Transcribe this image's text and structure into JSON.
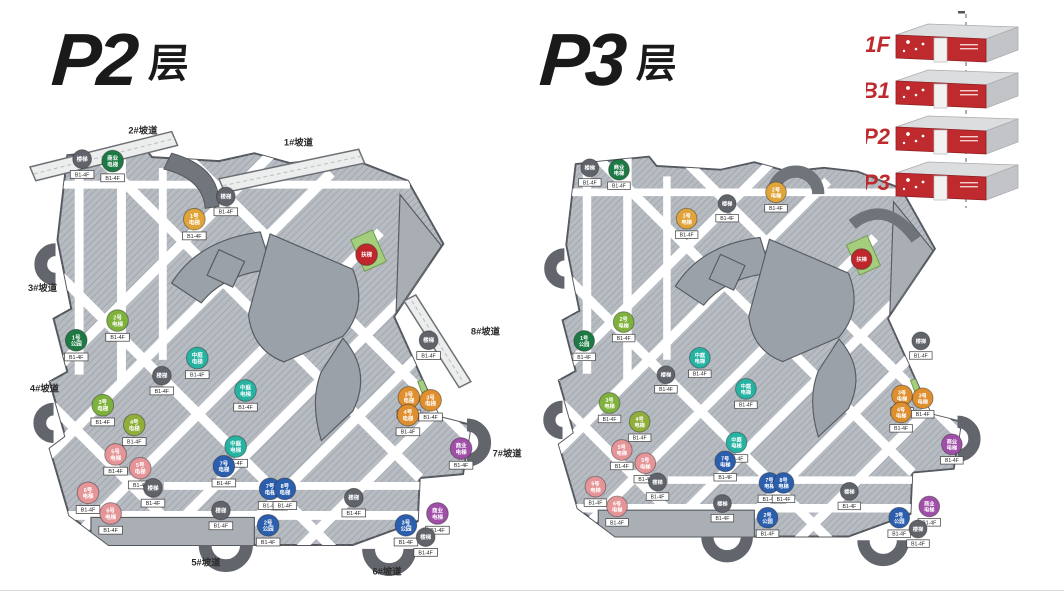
{
  "page": {
    "background": "#ffffff"
  },
  "titles": [
    {
      "main": "P2",
      "suffix": "层"
    },
    {
      "main": "P3",
      "suffix": "层"
    }
  ],
  "legend": {
    "accent": "#bf2a2e",
    "box_top": "#dcdddf",
    "box_side": "#c2c4c7",
    "levels": [
      "1F",
      "B1",
      "P2",
      "P3"
    ]
  },
  "palette": {
    "gray": "#60646a",
    "green": "#1e7a44",
    "lime": "#7fb23c",
    "olive": "#8fae3a",
    "teal": "#27b3a2",
    "orange": "#df8f2e",
    "amber": "#e0a43a",
    "blue": "#2b5fae",
    "pink": "#e59598",
    "purple": "#a04fa8",
    "red": "#c0272d"
  },
  "map_colors": {
    "body": "#b7bbc2",
    "lane": "#ffffff",
    "core": "#9ba1a9",
    "ramp": "#eceded",
    "loop": "#62666c",
    "green_patch": "#a5cd7e"
  },
  "marker_tag_default": "B1-4F",
  "plans": [
    {
      "name": "P2层",
      "variant": "a",
      "ramps": [
        {
          "label": "2#坡道",
          "x": 104,
          "y": 10
        },
        {
          "label": "1#坡道",
          "x": 262,
          "y": 22
        },
        {
          "label": "3#坡道",
          "x": 2,
          "y": 170
        },
        {
          "label": "4#坡道",
          "x": 4,
          "y": 272
        },
        {
          "label": "5#坡道",
          "x": 168,
          "y": 449
        },
        {
          "label": "6#坡道",
          "x": 352,
          "y": 458
        },
        {
          "label": "7#坡道",
          "x": 474,
          "y": 338
        },
        {
          "label": "8#坡道",
          "x": 452,
          "y": 214
        }
      ],
      "markers": [
        {
          "x": 57,
          "y": 36,
          "c": "gray",
          "t": [
            "楼梯"
          ]
        },
        {
          "x": 88,
          "y": 38,
          "c": "green",
          "t": [
            "商业",
            "电梯"
          ]
        },
        {
          "x": 171,
          "y": 97,
          "c": "amber",
          "t": [
            "1号",
            "电梯"
          ]
        },
        {
          "x": 203,
          "y": 74,
          "c": "gray",
          "t": [
            "楼梯"
          ]
        },
        {
          "x": 346,
          "y": 133,
          "c": "red",
          "t": [
            "扶梯"
          ],
          "tag": ""
        },
        {
          "x": 93,
          "y": 200,
          "c": "lime",
          "t": [
            "2号",
            "电梯"
          ]
        },
        {
          "x": 51,
          "y": 220,
          "c": "green",
          "t": [
            "1号",
            "公园"
          ]
        },
        {
          "x": 78,
          "y": 286,
          "c": "lime",
          "t": [
            "3号",
            "电梯"
          ]
        },
        {
          "x": 110,
          "y": 306,
          "c": "olive",
          "t": [
            "4号",
            "电梯"
          ]
        },
        {
          "x": 138,
          "y": 256,
          "c": "gray",
          "t": [
            "楼梯"
          ]
        },
        {
          "x": 174,
          "y": 238,
          "c": "teal",
          "t": [
            "中庭",
            "电梯"
          ]
        },
        {
          "x": 223,
          "y": 271,
          "c": "teal",
          "t": [
            "中庭",
            "电梯"
          ]
        },
        {
          "x": 409,
          "y": 220,
          "c": "gray",
          "t": [
            "楼梯"
          ]
        },
        {
          "x": 91,
          "y": 336,
          "c": "pink",
          "t": [
            "5号",
            "电梯"
          ]
        },
        {
          "x": 116,
          "y": 350,
          "c": "pink",
          "t": [
            "5号",
            "电梯"
          ]
        },
        {
          "x": 63,
          "y": 375,
          "c": "pink",
          "t": [
            "6号",
            "电梯"
          ]
        },
        {
          "x": 86,
          "y": 396,
          "c": "pink",
          "t": [
            "6号",
            "电梯"
          ]
        },
        {
          "x": 129,
          "y": 370,
          "c": "gray",
          "t": [
            "楼梯"
          ]
        },
        {
          "x": 213,
          "y": 328,
          "c": "teal",
          "t": [
            "中庭",
            "电梯"
          ]
        },
        {
          "x": 201,
          "y": 348,
          "c": "blue",
          "t": [
            "7号",
            "电梯"
          ]
        },
        {
          "x": 248,
          "y": 371,
          "c": "blue",
          "t": [
            "7号",
            "电梯"
          ]
        },
        {
          "x": 263,
          "y": 371,
          "c": "blue",
          "t": [
            "8号",
            "电梯"
          ]
        },
        {
          "x": 246,
          "y": 408,
          "c": "blue",
          "t": [
            "2号",
            "公园"
          ]
        },
        {
          "x": 198,
          "y": 393,
          "c": "gray",
          "t": [
            "楼梯"
          ]
        },
        {
          "x": 389,
          "y": 278,
          "c": "orange",
          "t": [
            "3号",
            "电梯"
          ]
        },
        {
          "x": 411,
          "y": 281,
          "c": "orange",
          "t": [
            "3号",
            "电梯"
          ]
        },
        {
          "x": 388,
          "y": 296,
          "c": "orange",
          "t": [
            "4号",
            "电梯"
          ]
        },
        {
          "x": 442,
          "y": 330,
          "c": "purple",
          "t": [
            "商业",
            "电梯"
          ]
        },
        {
          "x": 418,
          "y": 396,
          "c": "purple",
          "t": [
            "商业",
            "电梯"
          ]
        },
        {
          "x": 386,
          "y": 408,
          "c": "blue",
          "t": [
            "3号",
            "公园"
          ]
        },
        {
          "x": 406,
          "y": 420,
          "c": "gray",
          "t": [
            "楼梯"
          ]
        },
        {
          "x": 333,
          "y": 380,
          "c": "gray",
          "t": [
            "楼梯"
          ]
        }
      ]
    },
    {
      "name": "P3层",
      "variant": "b",
      "ramps": [],
      "markers": [
        {
          "x": 57,
          "y": 36,
          "c": "gray",
          "t": [
            "楼梯"
          ]
        },
        {
          "x": 88,
          "y": 38,
          "c": "green",
          "t": [
            "商业",
            "电梯"
          ]
        },
        {
          "x": 160,
          "y": 90,
          "c": "amber",
          "t": [
            "1号",
            "电梯"
          ]
        },
        {
          "x": 255,
          "y": 62,
          "c": "amber",
          "t": [
            "2号",
            "电梯"
          ]
        },
        {
          "x": 203,
          "y": 74,
          "c": "gray",
          "t": [
            "楼梯"
          ]
        },
        {
          "x": 346,
          "y": 133,
          "c": "red",
          "t": [
            "扶梯"
          ],
          "tag": ""
        },
        {
          "x": 93,
          "y": 200,
          "c": "lime",
          "t": [
            "2号",
            "电梯"
          ]
        },
        {
          "x": 51,
          "y": 220,
          "c": "green",
          "t": [
            "1号",
            "公园"
          ]
        },
        {
          "x": 78,
          "y": 286,
          "c": "lime",
          "t": [
            "3号",
            "电梯"
          ]
        },
        {
          "x": 110,
          "y": 306,
          "c": "olive",
          "t": [
            "4号",
            "电梯"
          ]
        },
        {
          "x": 138,
          "y": 256,
          "c": "gray",
          "t": [
            "楼梯"
          ]
        },
        {
          "x": 174,
          "y": 238,
          "c": "teal",
          "t": [
            "中庭",
            "电梯"
          ]
        },
        {
          "x": 223,
          "y": 271,
          "c": "teal",
          "t": [
            "中庭",
            "电梯"
          ]
        },
        {
          "x": 409,
          "y": 220,
          "c": "gray",
          "t": [
            "楼梯"
          ]
        },
        {
          "x": 91,
          "y": 336,
          "c": "pink",
          "t": [
            "5号",
            "电梯"
          ]
        },
        {
          "x": 116,
          "y": 350,
          "c": "pink",
          "t": [
            "5号",
            "电梯"
          ]
        },
        {
          "x": 63,
          "y": 375,
          "c": "pink",
          "t": [
            "6号",
            "电梯"
          ]
        },
        {
          "x": 86,
          "y": 396,
          "c": "pink",
          "t": [
            "6号",
            "电梯"
          ]
        },
        {
          "x": 129,
          "y": 370,
          "c": "gray",
          "t": [
            "楼梯"
          ]
        },
        {
          "x": 213,
          "y": 328,
          "c": "teal",
          "t": [
            "中庭",
            "电梯"
          ]
        },
        {
          "x": 201,
          "y": 348,
          "c": "blue",
          "t": [
            "7号",
            "电梯"
          ]
        },
        {
          "x": 248,
          "y": 371,
          "c": "blue",
          "t": [
            "7号",
            "电梯"
          ]
        },
        {
          "x": 263,
          "y": 371,
          "c": "blue",
          "t": [
            "8号",
            "电梯"
          ]
        },
        {
          "x": 246,
          "y": 408,
          "c": "blue",
          "t": [
            "2号",
            "公园"
          ]
        },
        {
          "x": 198,
          "y": 393,
          "c": "gray",
          "t": [
            "楼梯"
          ]
        },
        {
          "x": 389,
          "y": 278,
          "c": "orange",
          "t": [
            "3号",
            "电梯"
          ]
        },
        {
          "x": 411,
          "y": 281,
          "c": "orange",
          "t": [
            "3号",
            "电梯"
          ]
        },
        {
          "x": 388,
          "y": 296,
          "c": "orange",
          "t": [
            "4号",
            "电梯"
          ]
        },
        {
          "x": 442,
          "y": 330,
          "c": "purple",
          "t": [
            "商业",
            "电梯"
          ]
        },
        {
          "x": 418,
          "y": 396,
          "c": "purple",
          "t": [
            "商业",
            "电梯"
          ]
        },
        {
          "x": 386,
          "y": 408,
          "c": "blue",
          "t": [
            "3号",
            "公园"
          ]
        },
        {
          "x": 406,
          "y": 420,
          "c": "gray",
          "t": [
            "楼梯"
          ]
        },
        {
          "x": 333,
          "y": 380,
          "c": "gray",
          "t": [
            "楼梯"
          ]
        }
      ]
    }
  ]
}
